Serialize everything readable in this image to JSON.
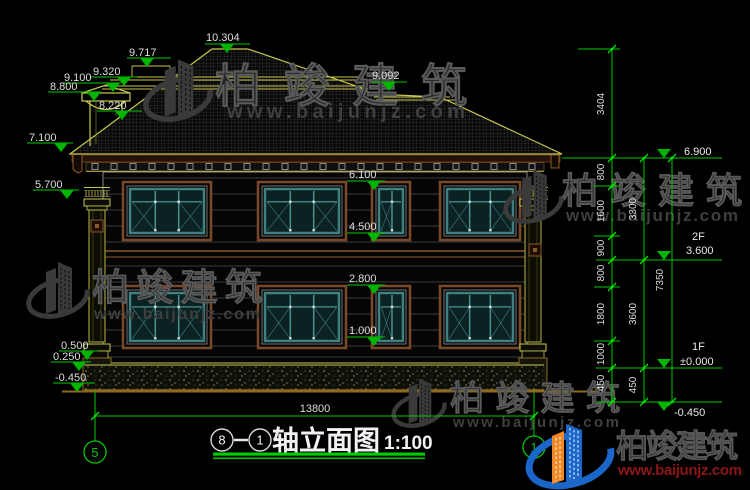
{
  "drawing": {
    "title": {
      "axis_bubble_start": "8",
      "axis_bubble_end": "1",
      "name": "轴立面图",
      "scale": "1:100"
    },
    "axis_bubbles": {
      "left": "5",
      "right": "1"
    },
    "bottom_dim": "13800",
    "levels": {
      "top": {
        "ridge": "10.304",
        "right_ridge": "9.092"
      },
      "left": [
        "9.717",
        "9.320",
        "9.100",
        "8.800",
        "8.220",
        "7.100",
        "5.700",
        "0.500",
        "0.250",
        "-0.450"
      ],
      "mid": [
        "6.100",
        "4.500",
        "2.800",
        "1.000"
      ],
      "right": {
        "eave": "6.900",
        "floor2_label": "2F",
        "floor2": "3.600",
        "floor1_label": "1F",
        "floor1": "±0.000",
        "ground": "-0.450"
      }
    },
    "dims": {
      "chain_a": [
        "3404",
        "800",
        "1600",
        "900",
        "800",
        "1800",
        "1000",
        "450"
      ],
      "chain_b": [
        "3300",
        "3600",
        "450"
      ],
      "total": "7350"
    }
  },
  "watermark": {
    "brand": "柏竣建筑",
    "url": "www.baijunjz.com"
  },
  "colors": {
    "background": "#000000",
    "cad_green": "#00c800",
    "cad_yellow": "#c8c850",
    "dim_text": "#e0e0e0",
    "frame_brown": "#7a4a28",
    "window_teal": "#3f8080",
    "logo_blue": "#1b66c9",
    "logo_orange": "#f08828",
    "watermark_red": "#6e1414"
  }
}
